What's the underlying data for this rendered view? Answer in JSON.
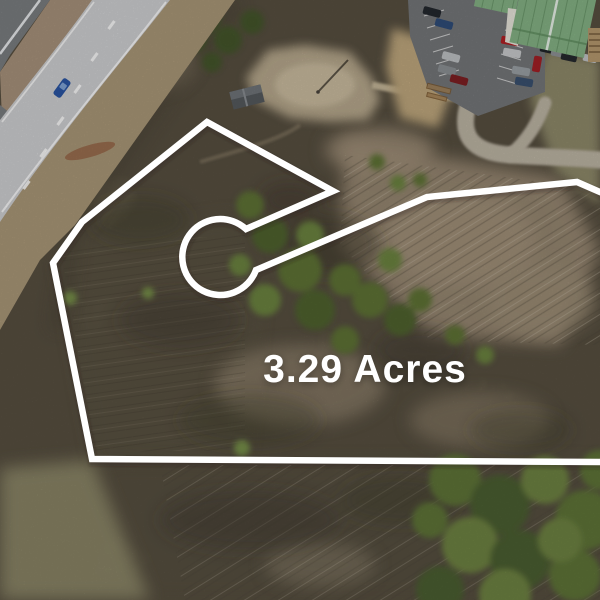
{
  "photo": {
    "kind": "aerial-drone-photo-of-land-parcel",
    "acreage_label": "3.29 Acres"
  },
  "colors": {
    "label-text": "#ffffff",
    "boundary": "#ffffff",
    "forest-base": "#81765f",
    "forest-dark": "#564f40",
    "cleared-tan": "#a2917a",
    "green-tree": "#5e7336",
    "green-tree-dark": "#45562b",
    "highway": "#d0d1d3",
    "dark-road": "#7b7e81",
    "median-grass": "#a8937c",
    "shoulder-grass": "#ab9878",
    "asphalt": "#75777a",
    "roof-green": "#85b385",
    "dirt": "#c0a87e",
    "gravel": "#beb6a5",
    "olive-grass": "#8f8a6a",
    "dirt-mound": "#c49a74",
    "clearing": "#bdae92"
  }
}
